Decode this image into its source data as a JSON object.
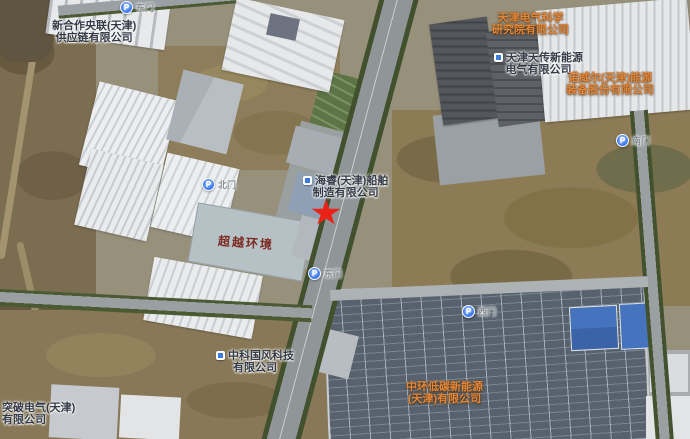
{
  "map": {
    "view": "satellite",
    "companies": [
      {
        "line1": "新合作央联(天津)",
        "line2": "供应链有限公司"
      },
      {
        "line1": "天津电气科学",
        "line2": "研究院有限公司"
      },
      {
        "line1": "天津天传新能源",
        "line2": "电气有限公司"
      },
      {
        "line1": "诺威尔(天津)能源",
        "line2": "装备股份有限公司"
      },
      {
        "line1": "海睿(天津)船舶",
        "line2": "制造有限公司"
      },
      {
        "line1": "中科国风科技",
        "line2": "有限公司"
      },
      {
        "line1": "中环低碳新能源",
        "line2": "(天津)有限公司"
      },
      {
        "line1": "突破电气(天津)",
        "line2": "有限公司"
      }
    ],
    "gates": [
      {
        "icon": "P",
        "label": "东门"
      },
      {
        "icon": "P",
        "label": "北门"
      },
      {
        "icon": "P",
        "label": "东门"
      },
      {
        "icon": "P",
        "label": "西门"
      },
      {
        "icon": "P",
        "label": "南门"
      }
    ],
    "rooftop_text": "超越环境",
    "marker": {
      "type": "red-star",
      "color": "#ea2318"
    },
    "label_colors": {
      "company_orange": "#e2873c",
      "company_dark": "#333a46",
      "gate_gray": "#878d93",
      "rooftop_red": "#7d2a22"
    }
  }
}
